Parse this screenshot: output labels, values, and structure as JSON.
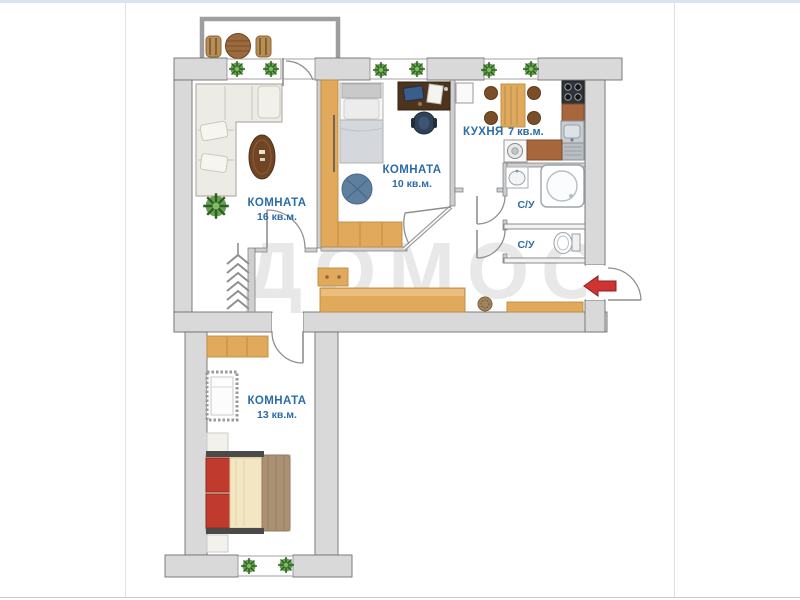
{
  "page": {
    "top_strip_color": "#d8e4ef"
  },
  "watermark": {
    "title": "ДОМОС",
    "subtitle": "CLUB"
  },
  "rooms": {
    "living": {
      "name": "КОМНАТА",
      "area": "16 кв.м."
    },
    "bedroom": {
      "name": "КОМНАТА",
      "area": "10 кв.м."
    },
    "kitchen": {
      "name": "КУХНЯ",
      "area": "7 кв.м."
    },
    "bath_top": {
      "name": "С/У"
    },
    "bath_bottom": {
      "name": "С/У"
    },
    "child_room": {
      "name": "КОМНАТА",
      "area": "13 кв.м."
    }
  },
  "colors": {
    "label_blue": "#2b6ca8",
    "wall_fill": "#d9d9d9",
    "wall_stroke": "#6f6f6f",
    "wood": "#e0a95c",
    "arrow_red": "#ce3434",
    "watermark_gray": "#d6d6d6",
    "plant_green": "#57953f",
    "top_strip": "#d8e4ef"
  }
}
